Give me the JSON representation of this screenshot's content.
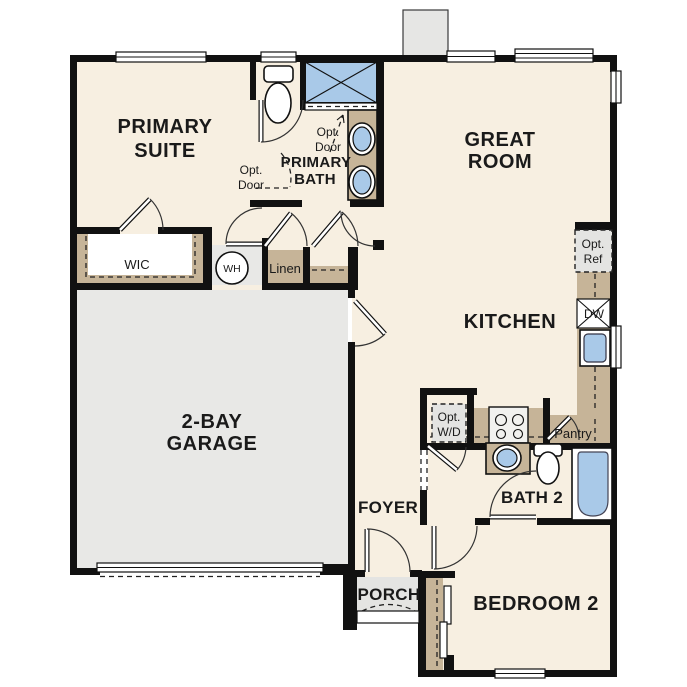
{
  "colors": {
    "floor": "#f7efe1",
    "garage": "#e8e8e6",
    "wall": "#111111",
    "cabinet": "#c6b498",
    "fixture_blue": "#a9c9e8",
    "optional_box": "#e4e4e2",
    "porch": "#e4e4e2"
  },
  "rooms": {
    "primary_suite": [
      "PRIMARY",
      "SUITE"
    ],
    "primary_bath": [
      "PRIMARY",
      "BATH"
    ],
    "great_room": [
      "GREAT",
      "ROOM"
    ],
    "kitchen": "KITCHEN",
    "garage": [
      "2-BAY",
      "GARAGE"
    ],
    "bedroom2": "BEDROOM 2",
    "bath2": "BATH 2",
    "foyer": "FOYER",
    "porch": "PORCH",
    "wic": "WIC",
    "linen": "Linen",
    "pantry": "Pantry"
  },
  "annotations": {
    "wh": "WH",
    "dw": "DW",
    "opt_door": [
      "Opt.",
      "Door"
    ],
    "opt_ref": [
      "Opt.",
      "Ref"
    ],
    "opt_wd": [
      "Opt.",
      "W/D"
    ]
  }
}
